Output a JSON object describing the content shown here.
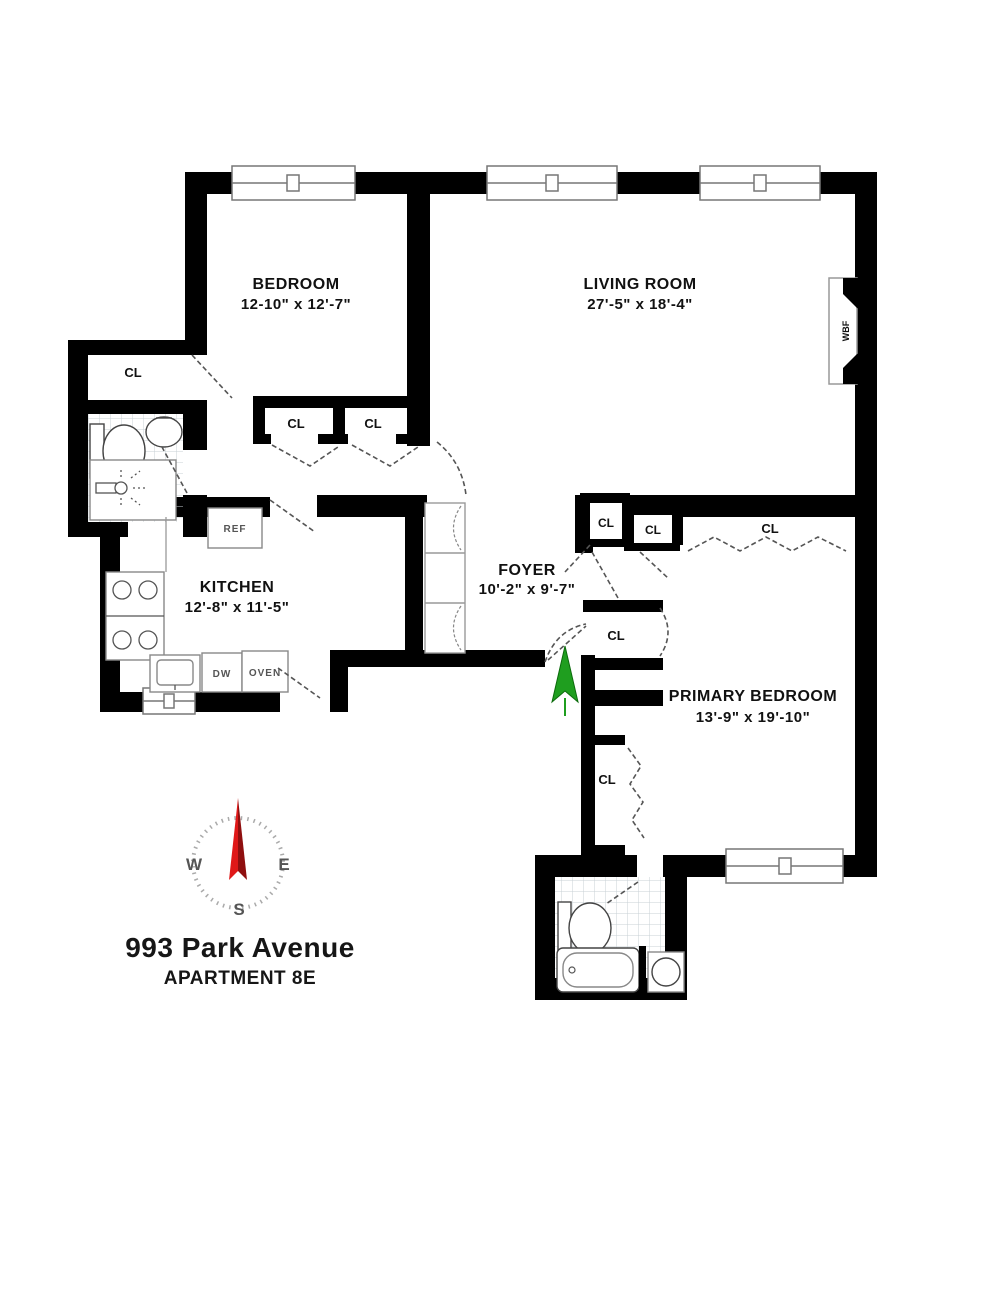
{
  "title": {
    "address": "993 Park Avenue",
    "unit": "APARTMENT 8E"
  },
  "rooms": {
    "bedroom": {
      "name": "BEDROOM",
      "dims": "12-10\" x 12'-7\""
    },
    "living_room": {
      "name": "LIVING ROOM",
      "dims": "27'-5\" x 18'-4\""
    },
    "kitchen": {
      "name": "KITCHEN",
      "dims": "12'-8\" x 11'-5\""
    },
    "foyer": {
      "name": "FOYER",
      "dims": "10'-2\" x 9'-7\""
    },
    "primary_bedroom": {
      "name": "PRIMARY BEDROOM",
      "dims": "13'-9\" x 19'-10\""
    }
  },
  "labels": {
    "closet": "CL",
    "refrigerator": "REF",
    "dishwasher": "DW",
    "oven": "OVEN",
    "fireplace": "WBF"
  },
  "compass": {
    "west": "W",
    "east": "E",
    "south": "S"
  },
  "colors": {
    "wall": "#000000",
    "entry_arrow": "#1f9e1f",
    "compass_needle_light": "#e01818",
    "compass_needle_dark": "#8f0f0f"
  }
}
